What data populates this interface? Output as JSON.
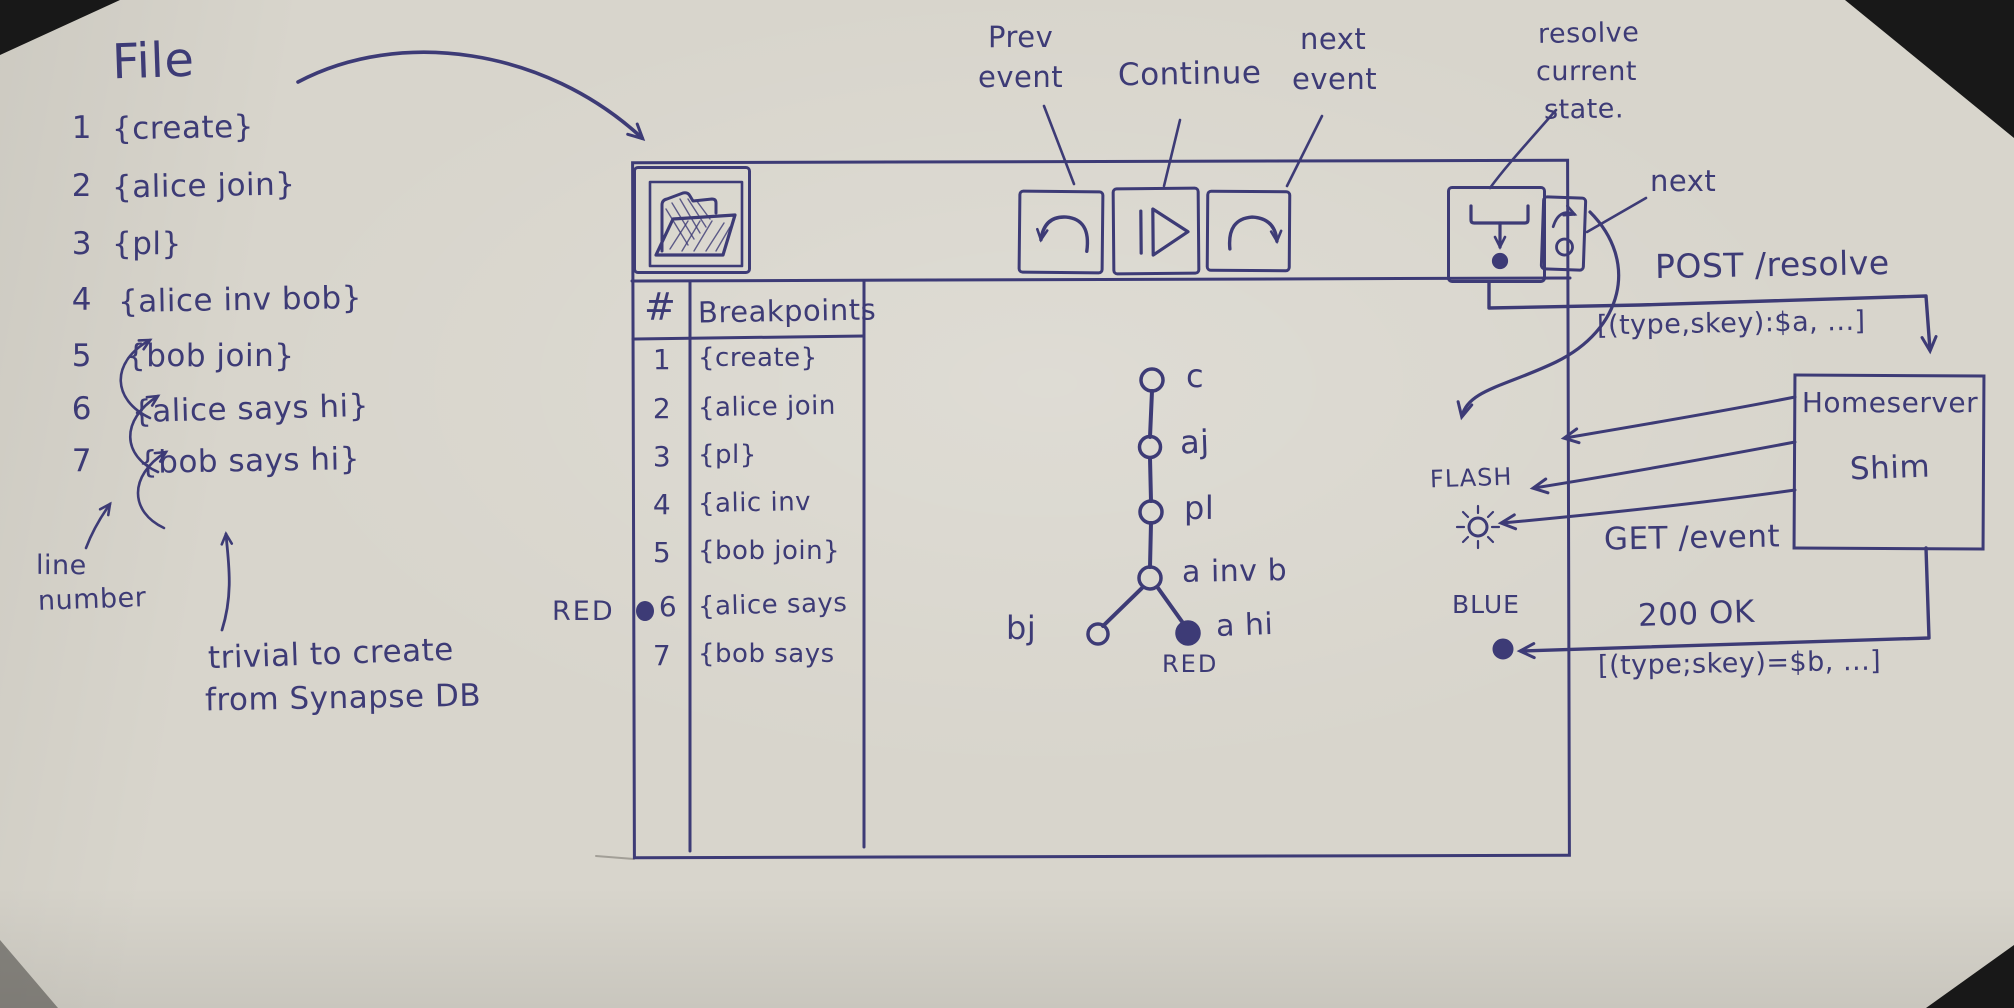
{
  "colors": {
    "ink": "#3d3b76",
    "paper": "#d8d5cc"
  },
  "file_panel": {
    "title": "File",
    "lines": [
      {
        "num": "1",
        "text": "{create}"
      },
      {
        "num": "2",
        "text": "{alice join}"
      },
      {
        "num": "3",
        "text": "{pl}"
      },
      {
        "num": "4",
        "text": "{alice inv bob}"
      },
      {
        "num": "5",
        "text": "{bob join}"
      },
      {
        "num": "6",
        "text": "{alice says hi}"
      },
      {
        "num": "7",
        "text": "{bob says hi}"
      }
    ],
    "annotation_line1": "line",
    "annotation_line2": "number",
    "note_line1": "trivial to create",
    "note_line2": "from Synapse DB"
  },
  "window": {
    "callouts": {
      "prev_line1": "Prev",
      "prev_line2": "event",
      "continue_label": "Continue",
      "next_line1": "next",
      "next_line2": "event",
      "resolve_line1": "resolve",
      "resolve_line2": "current",
      "resolve_line3": "state.",
      "next_step": "next"
    },
    "toolbar": {
      "open_icon": "open-folder-icon",
      "prev_event_icon": "undo-arrow-icon",
      "continue_icon": "pause-play-icon",
      "next_event_icon": "redo-arrow-icon",
      "resolve_icon": "merge-arrow-icon",
      "next_step_icon": "step-arrow-icon"
    },
    "breakpoints": {
      "header_num": "#",
      "header_name": "Breakpoints",
      "marker_label": "RED",
      "rows": [
        {
          "num": "1",
          "text": "{create}"
        },
        {
          "num": "2",
          "text": "{alice join"
        },
        {
          "num": "3",
          "text": "{pl}"
        },
        {
          "num": "4",
          "text": "{alic inv"
        },
        {
          "num": "5",
          "text": "{bob join}"
        },
        {
          "num": "6",
          "text": "{alice says"
        },
        {
          "num": "7",
          "text": "{bob says"
        }
      ]
    },
    "dag": {
      "node_labels": [
        "c",
        "aj",
        "pl",
        "a inv b",
        "bj",
        "a hi"
      ],
      "red_label": "RED"
    }
  },
  "sequence": {
    "post_request": "POST /resolve",
    "post_payload": "[(type,skey):$a, ...]",
    "server_line1": "Homeserver",
    "server_line2": "Shim",
    "flash_label": "FLASH",
    "get_request": "GET /event",
    "blue_label": "BLUE",
    "response_status": "200 OK",
    "response_payload": "[(type;skey)=$b, ...]"
  }
}
